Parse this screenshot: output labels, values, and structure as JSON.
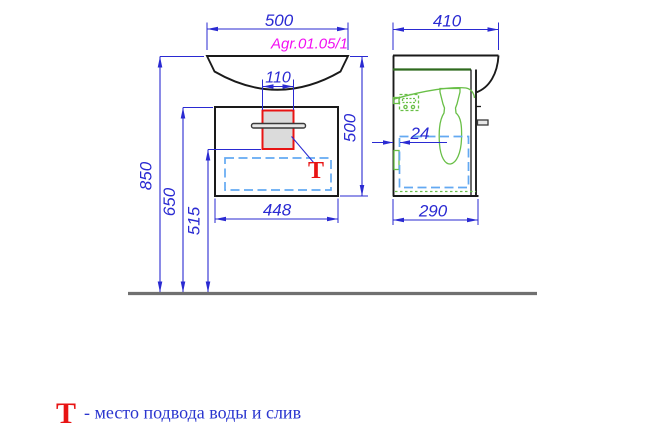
{
  "model_label": "Agr.01.05/1",
  "front_view": {
    "dims": {
      "basin_width": "500",
      "drain_unit_width": "110",
      "height": "500",
      "floor_to_basin_top": "850",
      "floor_to_cabinet_top": "650",
      "floor_to_drain": "515",
      "cabinet_width": "448"
    },
    "t_marker": "Т"
  },
  "side_view": {
    "dims": {
      "basin_depth": "410",
      "wall_gap": "24",
      "cabinet_depth": "290"
    }
  },
  "legend": {
    "symbol": "Т",
    "description": "- место подвода воды и слив"
  },
  "colors": {
    "dimension_blue": "#2a2ad2",
    "model_magenta": "#f20ff2",
    "marker_red": "#e81414",
    "hidden_cyan": "#63a9f2",
    "fitting_green": "#69bf47",
    "outline_black": "#1a1a1a",
    "floor_gray": "#707070",
    "panel_gray_fill": "#dbdbdb"
  }
}
